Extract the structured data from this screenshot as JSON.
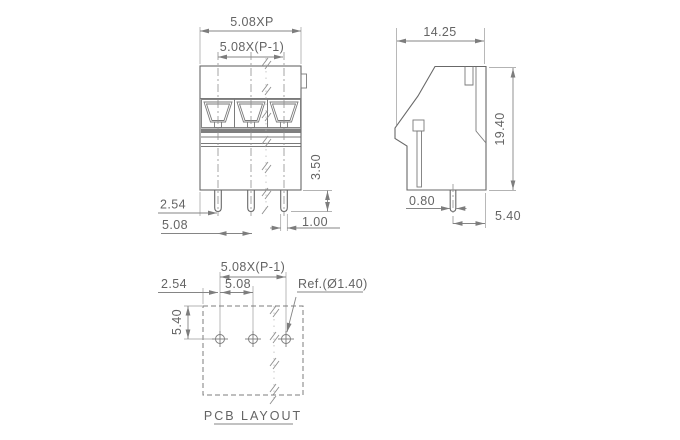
{
  "drawing": {
    "colors": {
      "background": "#ffffff",
      "line": "#686868",
      "dimension": "#858585",
      "text": "#646464"
    },
    "front_view": {
      "dim_total_width": "5.08XP",
      "dim_pole_span": "5.08X(P-1)",
      "dim_pin_offset": "2.54",
      "dim_pin_pitch": "5.08",
      "dim_pin_protrusion": "3.50",
      "dim_pin_width": "1.00"
    },
    "side_view": {
      "dim_depth": "14.25",
      "dim_height": "19.40",
      "dim_pin_thickness": "0.80",
      "dim_pin_to_back": "5.40"
    },
    "pcb_layout": {
      "dim_hole_span": "5.08X(P-1)",
      "dim_hole_pitch": "5.08",
      "dim_edge_offset": "2.54",
      "dim_row_offset": "5.40",
      "hole_ref": "Ref.(Ø1.40)",
      "caption": "PCB LAYOUT"
    }
  }
}
